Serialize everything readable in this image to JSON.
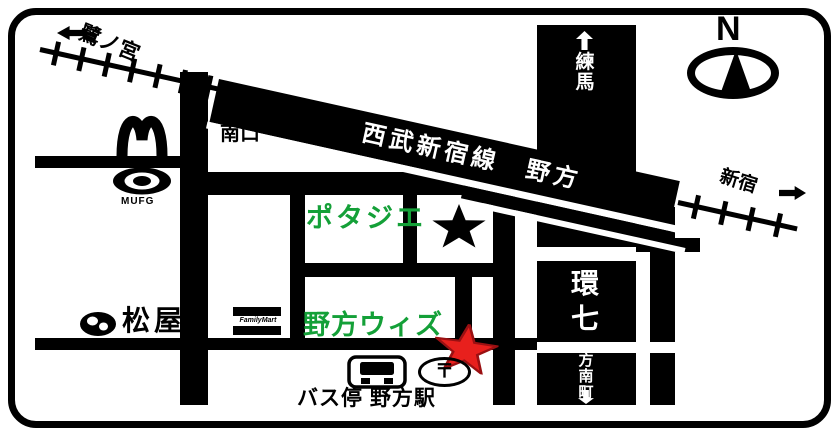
{
  "colors": {
    "road_black": "#000000",
    "landmark_green": "#14a038",
    "star_red": "#e8201d",
    "star_red_outline": "#9a1012"
  },
  "railway": {
    "band_label": "西武新宿線　野方",
    "left_destination": "鷺ノ宮",
    "right_destination": "新宿",
    "south_exit": "南口"
  },
  "compass": {
    "north": "N"
  },
  "roads": {
    "kannana": "環\n七",
    "north_destination": "練\n馬",
    "south_destination": "方\n南\n町"
  },
  "landmarks": {
    "potajie": "ポタジエ",
    "nogata_with": "野方ウィズ",
    "matsuya": "松屋",
    "mufg": "MUFG",
    "familymart": "FamilyMart",
    "bus_stop_station": "バス停 野方駅",
    "post_symbol": "〒"
  }
}
